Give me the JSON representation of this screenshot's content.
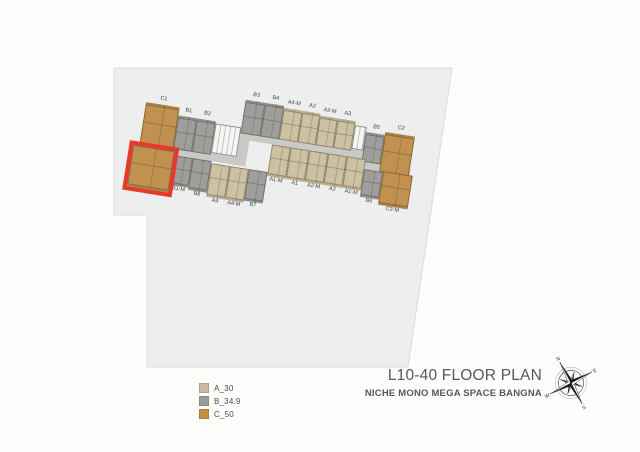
{
  "title_block": {
    "title": "L10-40 FLOOR PLAN",
    "subtitle": "NICHE MONO MEGA SPACE BANGNA"
  },
  "legend": {
    "items": [
      {
        "label": "A_30",
        "color": "#c8bb9b"
      },
      {
        "label": "B_34.9",
        "color": "#9b9b99"
      },
      {
        "label": "C_50",
        "color": "#c29144"
      }
    ]
  },
  "compass": {
    "directions": [
      "N",
      "E",
      "S",
      "W"
    ]
  },
  "site": {
    "points": "114,68 452,68 408,367 147,367 147,215 114,215",
    "fill": "#edefee",
    "stroke": "#d9dcda"
  },
  "floor_plan": {
    "angle_deg": 9,
    "origin": {
      "left": 146,
      "top": 90
    },
    "corridor_color": "#c9c9c7",
    "highlight_color": "#e8382c",
    "unit_colors": {
      "A": "#cdc1a3",
      "B": "#9e9e9c",
      "C": "#c0914f",
      "core": "#f5f5f3"
    },
    "corridors": [
      {
        "x": 2,
        "y": 52,
        "w": 102,
        "h": 8
      },
      {
        "x": 98,
        "y": 28,
        "w": 12,
        "h": 32
      },
      {
        "x": 104,
        "y": 26,
        "w": 122,
        "h": 8
      },
      {
        "x": 222,
        "y": 32,
        "w": 8,
        "h": 12
      },
      {
        "x": 224,
        "y": 37,
        "w": 50,
        "h": 7
      }
    ],
    "units": [
      {
        "label": "C1",
        "type": "C",
        "row": "top",
        "x": 2,
        "y": 12,
        "w": 34,
        "h": 40
      },
      {
        "label": "B1",
        "type": "B",
        "row": "top",
        "x": 36,
        "y": 20,
        "w": 19,
        "h": 32
      },
      {
        "label": "B2",
        "type": "B",
        "row": "top",
        "x": 55,
        "y": 20,
        "w": 19,
        "h": 32
      },
      {
        "label": "",
        "type": "core",
        "row": "top",
        "x": 74,
        "y": 22,
        "w": 26,
        "h": 30
      },
      {
        "label": "B3",
        "type": "B",
        "row": "top",
        "x": 100,
        "y": -6,
        "w": 20,
        "h": 32
      },
      {
        "label": "B4",
        "type": "B",
        "row": "top",
        "x": 120,
        "y": -6,
        "w": 19,
        "h": 32
      },
      {
        "label": "A4-M",
        "type": "A",
        "row": "top",
        "x": 139,
        "y": -4,
        "w": 19,
        "h": 30
      },
      {
        "label": "A2",
        "type": "A",
        "row": "top",
        "x": 158,
        "y": -4,
        "w": 18,
        "h": 30
      },
      {
        "label": "A2-M",
        "type": "A",
        "row": "top",
        "x": 176,
        "y": -2,
        "w": 18,
        "h": 28
      },
      {
        "label": "A3",
        "type": "A",
        "row": "top",
        "x": 194,
        "y": -2,
        "w": 18,
        "h": 28
      },
      {
        "label": "",
        "type": "core",
        "row": "top",
        "x": 212,
        "y": 2,
        "w": 12,
        "h": 24
      },
      {
        "label": "B5",
        "type": "B",
        "row": "top",
        "x": 224,
        "y": 7,
        "w": 19,
        "h": 28
      },
      {
        "label": "C2",
        "type": "C",
        "row": "top",
        "x": 243,
        "y": 4,
        "w": 30,
        "h": 38
      },
      {
        "label": "C3",
        "type": "C",
        "row": "bottom",
        "x": -4,
        "y": 56,
        "w": 42,
        "h": 40,
        "highlighted": true
      },
      {
        "label": "B1-M",
        "type": "B",
        "row": "bottom",
        "x": 38,
        "y": 60,
        "w": 19,
        "h": 28
      },
      {
        "label": "B8",
        "type": "B",
        "row": "bottom",
        "x": 57,
        "y": 60,
        "w": 19,
        "h": 30
      },
      {
        "label": "A4",
        "type": "A",
        "row": "bottom",
        "x": 76,
        "y": 62,
        "w": 19,
        "h": 32
      },
      {
        "label": "A4-M",
        "type": "A",
        "row": "bottom",
        "x": 95,
        "y": 62,
        "w": 19,
        "h": 32
      },
      {
        "label": "B7",
        "type": "B",
        "row": "bottom",
        "x": 114,
        "y": 62,
        "w": 19,
        "h": 30
      },
      {
        "label": "A1-M",
        "type": "A",
        "row": "bottom",
        "x": 133,
        "y": 34,
        "w": 19,
        "h": 30
      },
      {
        "label": "A1",
        "type": "A",
        "row": "bottom",
        "x": 152,
        "y": 34,
        "w": 19,
        "h": 30
      },
      {
        "label": "A2-M",
        "type": "A",
        "row": "bottom",
        "x": 171,
        "y": 34,
        "w": 19,
        "h": 30
      },
      {
        "label": "A2",
        "type": "A",
        "row": "bottom",
        "x": 190,
        "y": 34,
        "w": 19,
        "h": 30
      },
      {
        "label": "A1-M",
        "type": "A",
        "row": "bottom",
        "x": 209,
        "y": 34,
        "w": 19,
        "h": 30
      },
      {
        "label": "B6",
        "type": "B",
        "row": "bottom",
        "x": 228,
        "y": 44,
        "w": 19,
        "h": 26
      },
      {
        "label": "C2-M",
        "type": "C",
        "row": "bottom",
        "x": 247,
        "y": 43,
        "w": 30,
        "h": 32
      }
    ]
  }
}
